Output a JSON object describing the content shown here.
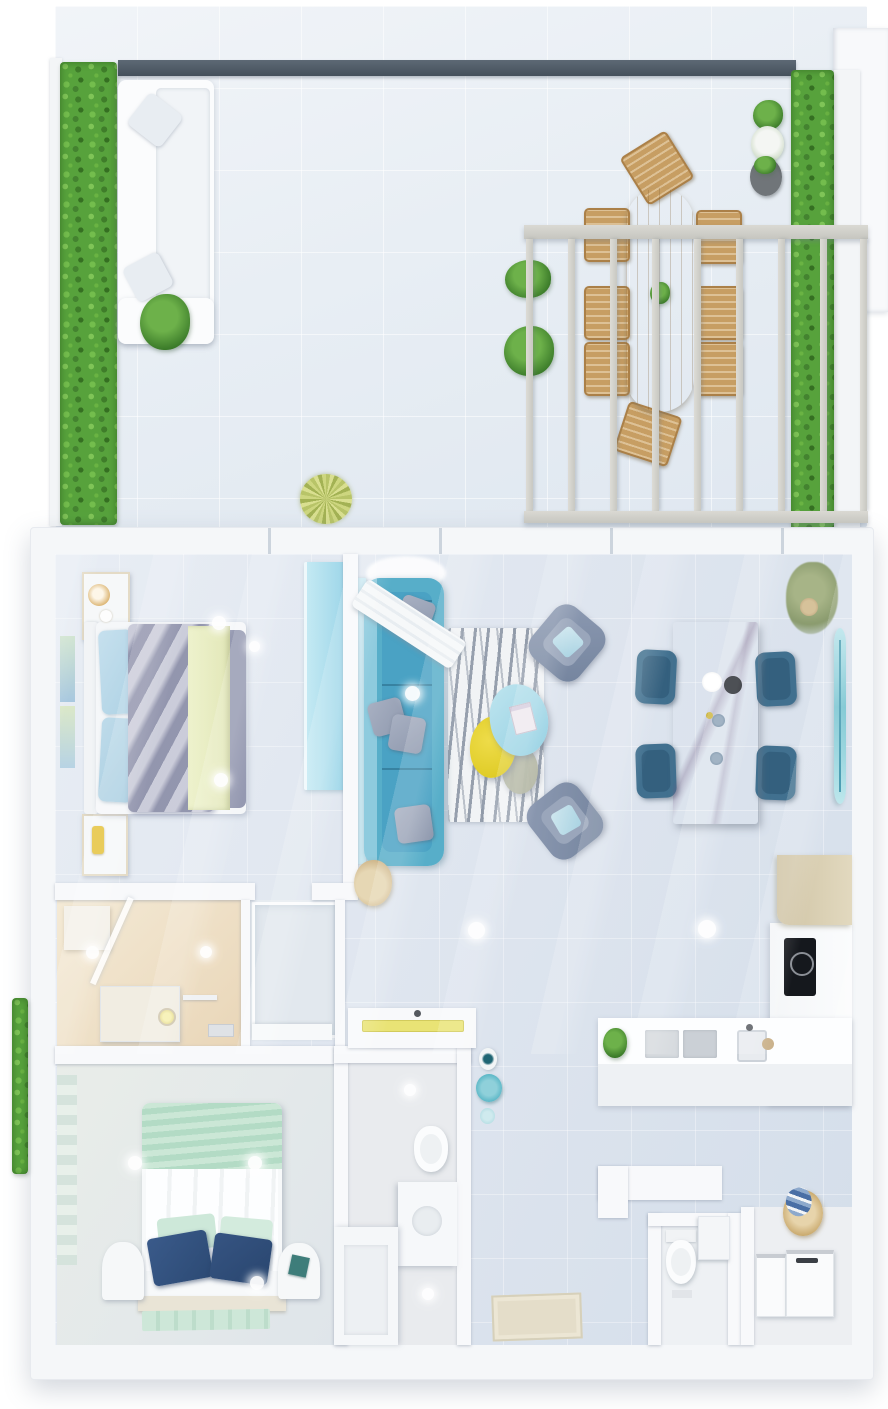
{
  "scene": {
    "type": "3d-floor-plan-top-down-render",
    "title": "Two-bedroom apartment with roof terrace — 3D floor plan",
    "orientation": "top-down"
  },
  "palette": {
    "page_bg": "#ffffff",
    "terrace_floor": "#e9eef3",
    "hedge": "#57a23c",
    "beam_dark": "#4e5a66",
    "pergola": "#d2d2cc",
    "wood": "#c59d62",
    "wall": "#f8f9fb",
    "floor": "#dfe6ee",
    "bath1_floor": "#eedfc6",
    "bed_duvet": "#a8aac0",
    "bed_blanket": "#e9edc6",
    "pillow_blue": "#b9d8e8",
    "wardrobe": "#abdeec",
    "sofa_teal": "#57aec9",
    "rug_stripe": "#939cab",
    "table_blue": "#a7dbe9",
    "table_yellow": "#e6d22f",
    "table_olive": "#b3b6a3",
    "armchair_gray": "#8290aa",
    "dining_wood": "#b5a58e",
    "chair_blue": "#41708f",
    "kitchen_beige": "#d9cfb3",
    "cooktop_black": "#171a1f",
    "mint": "#c6e6d4",
    "navy_pillow": "#31507e",
    "basket_tan": "#c9a96d",
    "mat_beige": "#e4ddc9",
    "vase_teal": "#57b5c5",
    "surfboard_teal": "#8fd2dc"
  },
  "terrace": {
    "label": "Roof terrace",
    "items": [
      "left hedge planter",
      "right vertical garden",
      "white outdoor lounge sofa",
      "potted plant",
      "ornamental grass",
      "oval wooden dining table",
      "eight wooden chairs",
      "pergola with slats",
      "three potted plants",
      "dark roof beam"
    ]
  },
  "rooms": [
    {
      "id": "bedroom-1",
      "label": "Master bedroom",
      "items": [
        "double bed with gray duvet",
        "two nightstands",
        "wall art",
        "blue wardrobe"
      ]
    },
    {
      "id": "living-room",
      "label": "Living room",
      "items": [
        "teal sofa",
        "zebra rug",
        "blue / yellow / olive coffee tables",
        "two gray armchairs",
        "surfboard",
        "hanging plant"
      ]
    },
    {
      "id": "dining-area",
      "label": "Dining area",
      "items": [
        "wooden dining table",
        "four blue chairs",
        "plates"
      ]
    },
    {
      "id": "kitchen",
      "label": "Kitchen",
      "items": [
        "L-shaped counter",
        "induction cooktop",
        "sink",
        "cutting boards",
        "beige tall cabinet",
        "plant"
      ]
    },
    {
      "id": "bathroom-1",
      "label": "Bathroom",
      "items": [
        "walk-in shower",
        "washing machine",
        "glass door",
        "shelf"
      ]
    },
    {
      "id": "shower-room",
      "label": "Shower room",
      "items": [
        "glass shower enclosure"
      ]
    },
    {
      "id": "bedroom-2",
      "label": "Second bedroom",
      "items": [
        "bed with mint throw and navy pillows",
        "two arched nightstands",
        "mint rug"
      ]
    },
    {
      "id": "bathroom-2",
      "label": "Second bathroom",
      "items": [
        "toilet",
        "vanity",
        "shower",
        "console with yellow tray"
      ]
    },
    {
      "id": "hallway",
      "label": "Entry hall",
      "items": [
        "doormat",
        "teal vases",
        "white console"
      ]
    },
    {
      "id": "wc",
      "label": "Guest WC",
      "items": [
        "toilet",
        "wall cabinet"
      ]
    },
    {
      "id": "laundry",
      "label": "Laundry room",
      "items": [
        "washer",
        "dryer",
        "laundry basket with blue towels"
      ]
    }
  ]
}
